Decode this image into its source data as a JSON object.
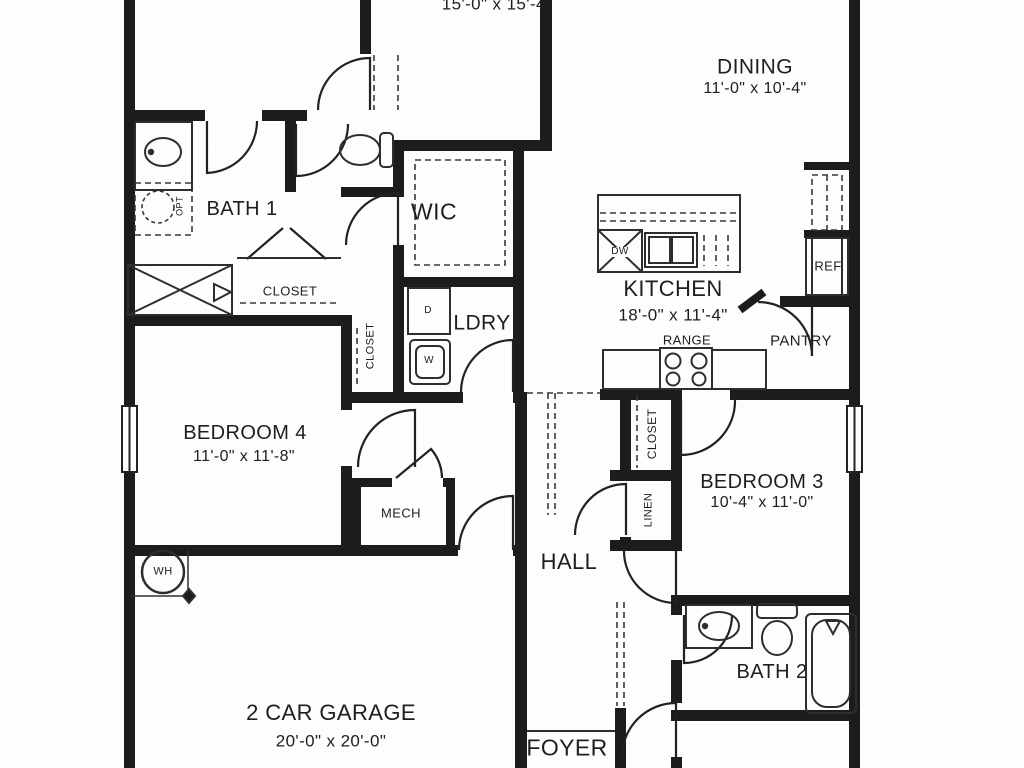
{
  "plan": {
    "rooms": {
      "top_room": {
        "dims": "15'-0\" x 15'-4\""
      },
      "dining": {
        "name": "DINING",
        "dims": "11'-0\" x 10'-4\""
      },
      "bath1": {
        "name": "BATH 1"
      },
      "wic": {
        "name": "WIC"
      },
      "laundry": {
        "name": "LDRY"
      },
      "kitchen": {
        "name": "KITCHEN",
        "dims": "18'-0\" x 11'-4\""
      },
      "pantry": {
        "name": "PANTRY"
      },
      "bedroom4": {
        "name": "BEDROOM 4",
        "dims": "11'-0\" x 11'-8\""
      },
      "bedroom3": {
        "name": "BEDROOM 3",
        "dims": "10'-4\" x 11'-0\""
      },
      "hall": {
        "name": "HALL"
      },
      "mech": {
        "name": "MECH"
      },
      "garage": {
        "name": "2 CAR GARAGE",
        "dims": "20'-0\" x 20'-0\""
      },
      "bath2": {
        "name": "BATH 2"
      },
      "foyer": {
        "name": "FOYER"
      }
    },
    "closets": {
      "bath1_closet": "CLOSET",
      "laundry_closet": "CLOSET",
      "hall_closet": "CLOSET",
      "linen": "LINEN"
    },
    "appliances": {
      "range": "RANGE",
      "refrigerator": "REF",
      "dishwasher": "DW",
      "dryer": "D",
      "washer": "W",
      "water_heater": "WH",
      "optional": "OPT"
    },
    "colors": {
      "wall": "#1c1c1c",
      "line": "#2e2e2e",
      "background": "#fdfdfd"
    },
    "icons": {
      "door-swing-icon": "quarter-circle arc",
      "window-icon": "double-line wall break",
      "sink-icon": "oval basin with faucet dot",
      "toilet-icon": "oval bowl with tank",
      "bathtub-icon": "rounded tub with faucet triangle",
      "shower-tub-icon": "rectangle with X",
      "range-burners-icon": "four circles",
      "kitchen-sink-icon": "double basin",
      "dishwasher-icon": "square with X",
      "water-heater-icon": "circle",
      "shelf-icon": "dashed line"
    }
  }
}
